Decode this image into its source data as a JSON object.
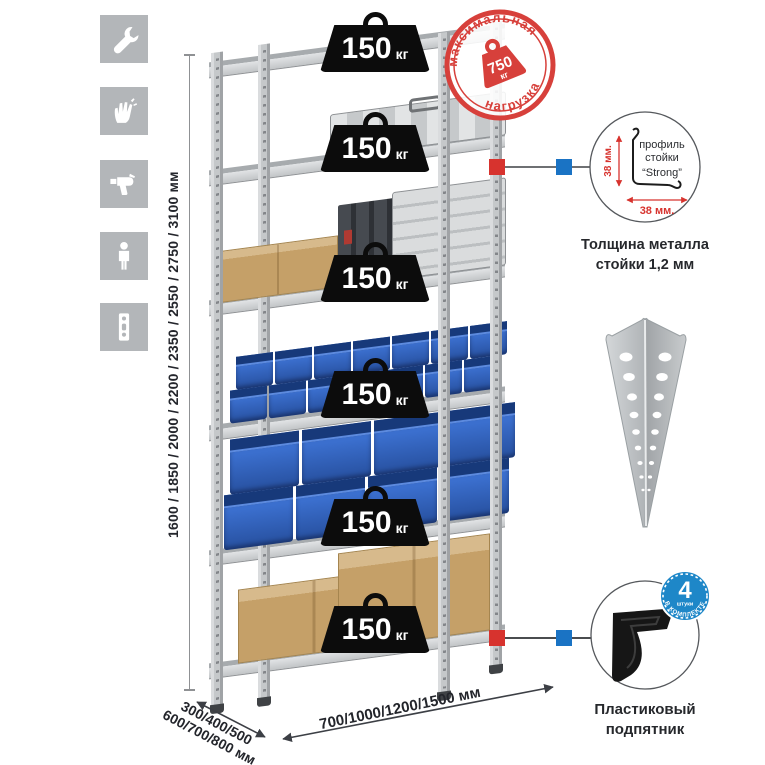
{
  "title": "Metal shelving rack product illustration",
  "left_icons": [
    {
      "name": "wrench"
    },
    {
      "name": "gloves"
    },
    {
      "name": "drill"
    },
    {
      "name": "person"
    },
    {
      "name": "perforated-strip"
    }
  ],
  "height_dimension": {
    "label": "1600 / 1850 / 2000 / 2200 / 2350 / 2550 / 2750 / 3100 мм"
  },
  "depth_dimension": {
    "line1": "300/400/500",
    "line2": "600/700/800 мм"
  },
  "width_dimension": {
    "label": "700/1000/1200/1500 мм"
  },
  "rack": {
    "shelf_count": 6,
    "load_badges": [
      {
        "value": "150",
        "unit": "кг"
      },
      {
        "value": "150",
        "unit": "кг"
      },
      {
        "value": "150",
        "unit": "кг"
      },
      {
        "value": "150",
        "unit": "кг"
      },
      {
        "value": "150",
        "unit": "кг"
      },
      {
        "value": "150",
        "unit": "кг"
      }
    ]
  },
  "max_load_stamp": {
    "arc_top": "максимальная",
    "arc_bottom": "нагрузка",
    "value": "750",
    "unit": "кг"
  },
  "profile_detail": {
    "line1": "профиль",
    "line2": "стойки",
    "line3": "“Strong”",
    "dim_vertical": "38 мм.",
    "dim_horizontal": "38 мм.",
    "caption_line1": "Толщина металла",
    "caption_line2": "стойки 1,2 мм"
  },
  "foot_detail": {
    "badge_value": "4",
    "badge_unit": "штуки",
    "badge_arc": "в комплекте",
    "caption_line1": "Пластиковый",
    "caption_line2": "подпятник"
  },
  "colors": {
    "accent_red": "#d7332e",
    "accent_blue": "#1a73c4",
    "bin_blue": "#2e5fb7",
    "cardboard": "#c5a068",
    "metal": "#c6c9cb",
    "icon_bg": "#b3b6b9"
  }
}
